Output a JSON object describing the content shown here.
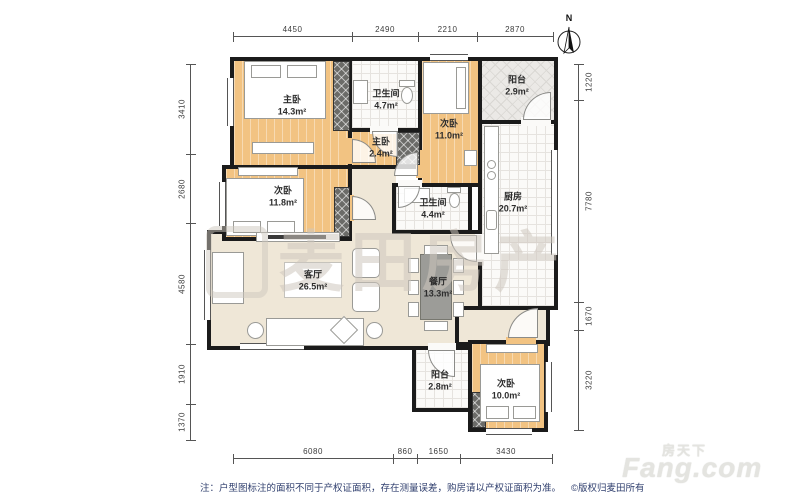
{
  "meta": {
    "north": "N",
    "watermark_center": "麦田房产",
    "brand_cn": "房天下",
    "brand_en": "Fang.com",
    "note": "注：户型图标注的面积不同于产权证面积，存在测量误差，购房请以产权证面积为准。",
    "copyright": "©版权归麦田所有"
  },
  "rooms": [
    {
      "name": "主卧",
      "area": "14.3m²"
    },
    {
      "name": "次卧",
      "area": "11.8m²"
    },
    {
      "name": "卫生间",
      "area": "4.7m²"
    },
    {
      "name": "主卧",
      "area": "2.4m²"
    },
    {
      "name": "次卧",
      "area": "11.0m²"
    },
    {
      "name": "阳台",
      "area": "2.9m²"
    },
    {
      "name": "厨房",
      "area": "20.7m²"
    },
    {
      "name": "卫生间",
      "area": "4.4m²"
    },
    {
      "name": "客厅",
      "area": "26.5m²"
    },
    {
      "name": "餐厅",
      "area": "13.3m²"
    },
    {
      "name": "阳台",
      "area": "2.8m²"
    },
    {
      "name": "次卧",
      "area": "10.0m²"
    }
  ],
  "dimensions": {
    "top": [
      "4450",
      "2490",
      "2210",
      "2870"
    ],
    "bottom": [
      "6080",
      "860",
      "1650",
      "3430"
    ],
    "left": [
      "3410",
      "2680",
      "4580",
      "1910",
      "1370"
    ],
    "right": [
      "1220",
      "7780",
      "1670",
      "3220"
    ]
  },
  "colors": {
    "wall": "#1b1b1b",
    "bedroom_floor": "#f2c382",
    "hall_floor": "#efe7d7",
    "tile_floor": "#fbfaf8",
    "balcony_floor": "#ebe9e6",
    "note_text": "#31406f"
  }
}
